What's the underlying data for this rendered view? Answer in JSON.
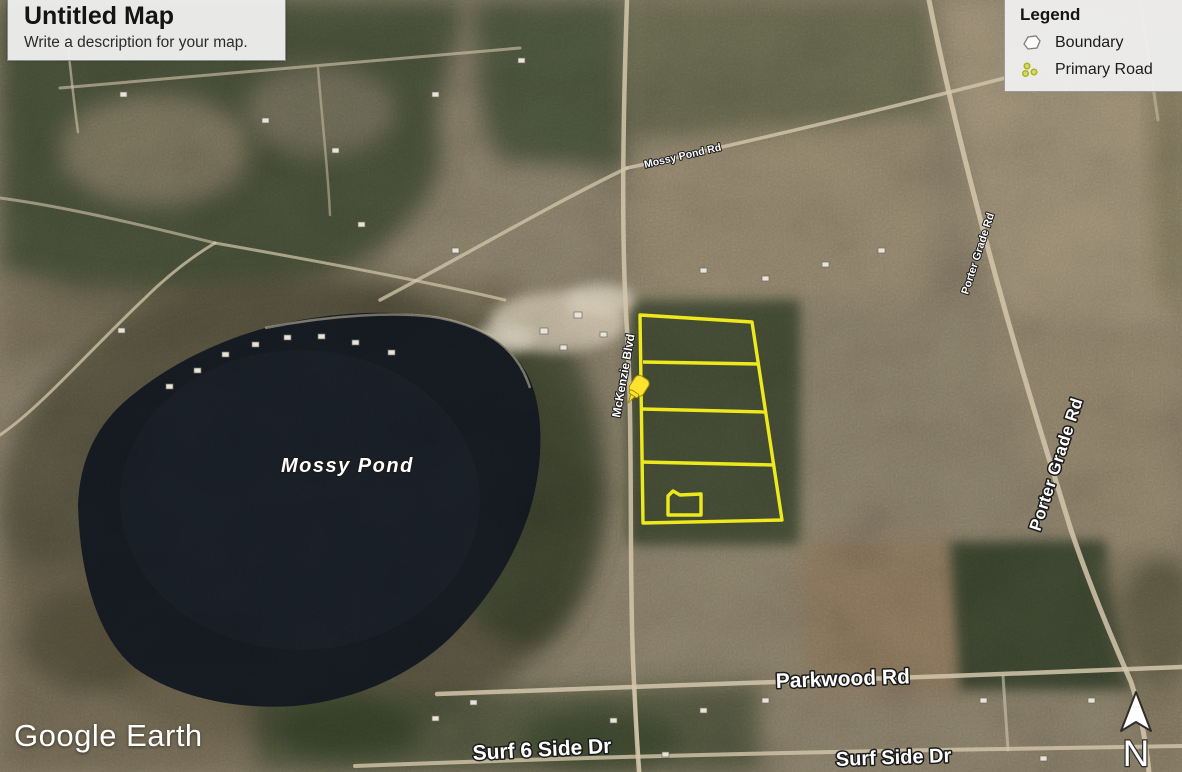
{
  "title_card": {
    "title": "Untitled Map",
    "description": "Write a description for your map."
  },
  "legend": {
    "title": "Legend",
    "items": [
      {
        "label": "Boundary",
        "icon": "boundary-polygon-icon"
      },
      {
        "label": "Primary Road",
        "icon": "primary-road-icon"
      }
    ]
  },
  "map": {
    "labels": {
      "pond": "Mossy Pond",
      "mckenzie_blvd": "McKenzie Blvd",
      "mossy_pond_rd": "Mossy Pond Rd",
      "porter_grade_rd_upper": "Porter Grade Rd",
      "porter_grade_rd": "Porter Grade Rd",
      "parkwood_rd": "Parkwood Rd",
      "surf_6_side_dr": "Surf 6 Side Dr",
      "surf_side_dr": "Surf Side Dr"
    },
    "marker": {
      "name": "yellow-pushpin"
    }
  },
  "branding": {
    "logo_text": "Google Earth"
  },
  "compass": {
    "north_label": "N"
  },
  "colors": {
    "boundary_yellow": "#f4ef1c",
    "pushpin_yellow": "#ffe32e",
    "legend_road_icon": "#d4d86a",
    "water_dark": "#151a21"
  }
}
